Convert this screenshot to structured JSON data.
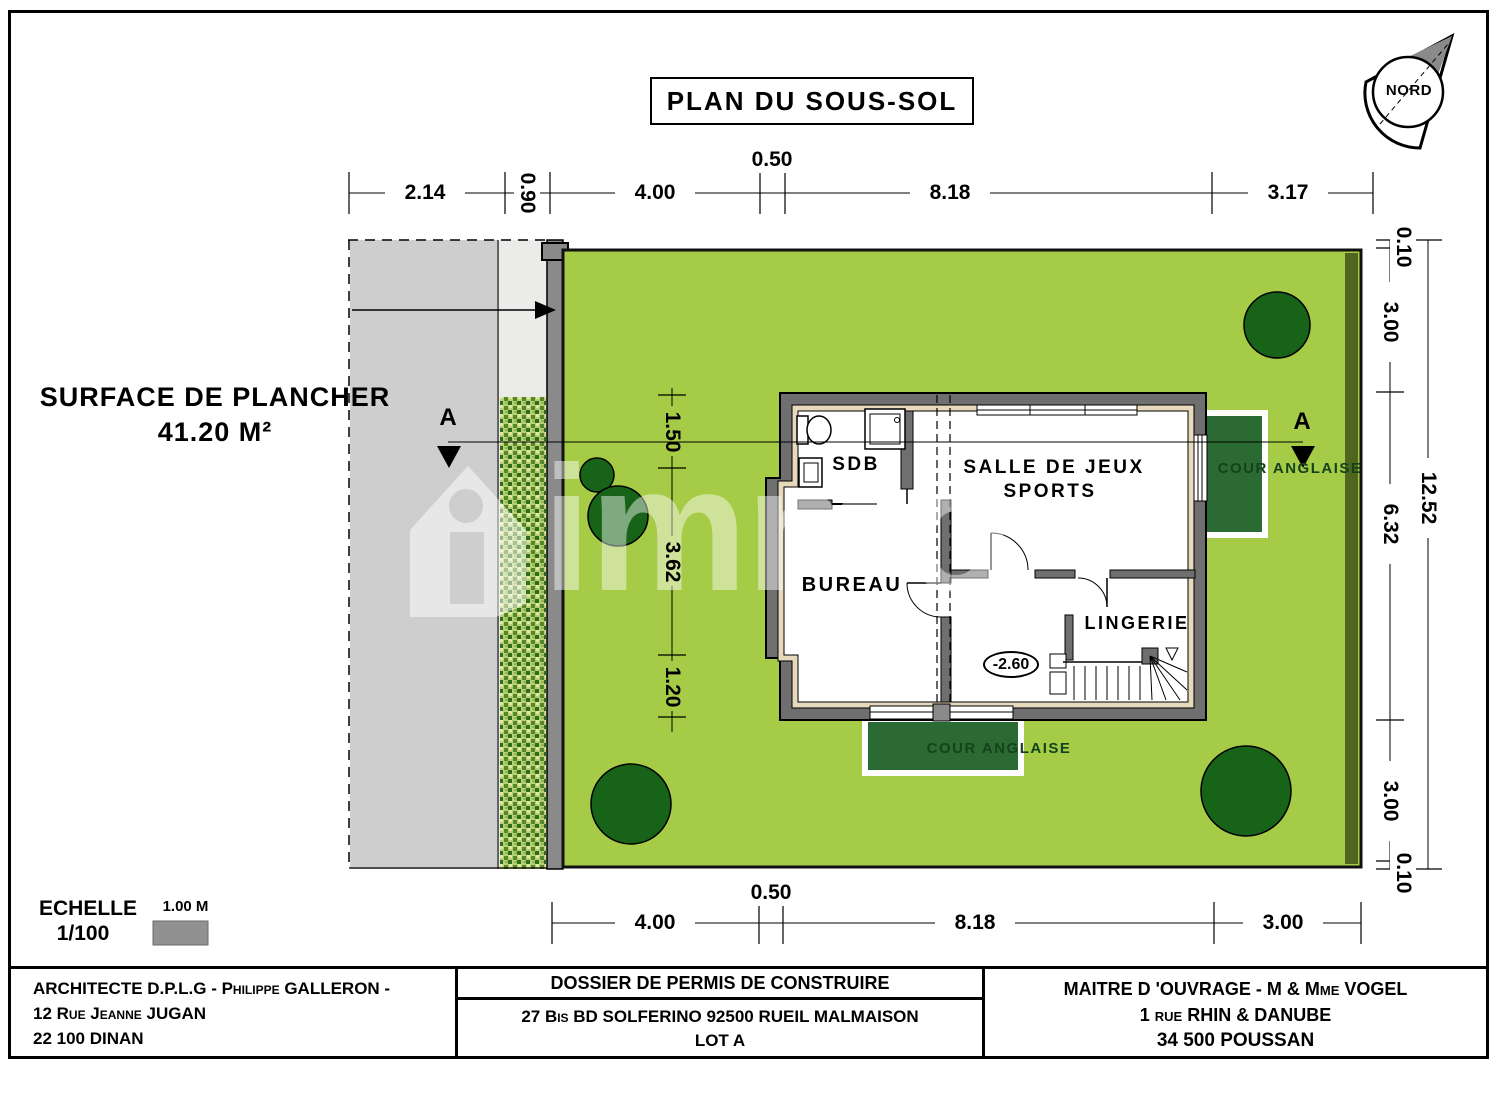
{
  "title": "PLAN DU SOUS-SOL",
  "compass": {
    "label": "NORD"
  },
  "surface": {
    "label": "SURFACE DE PLANCHER",
    "value": "41.20 M²"
  },
  "scale": {
    "label": "ECHELLE",
    "ratio": "1/100",
    "bar_label": "1.00 M"
  },
  "dims": {
    "top": [
      "2.14",
      "0.90",
      "4.00",
      "0.50",
      "8.18",
      "3.17"
    ],
    "right_inner": [
      "0.10",
      "3.00",
      "6.32",
      "3.00",
      "0.10"
    ],
    "right_outer": "12.52",
    "bottom": [
      "4.00",
      "0.50",
      "8.18",
      "3.00"
    ],
    "interior": [
      "1.50",
      "3.62",
      "1.20"
    ]
  },
  "section": {
    "marker_left": "A",
    "marker_right": "A"
  },
  "rooms": {
    "sdb": "SDB",
    "salle_line1": "SALLE DE JEUX",
    "salle_line2": "SPORTS",
    "bureau": "BUREAU",
    "lingerie": "LINGERIE",
    "level": "-2.60"
  },
  "site": {
    "cour_right": "COUR ANGLAISE",
    "cour_bottom": "COUR ANGLAISE"
  },
  "watermark": "immo",
  "titleblock": {
    "architect": [
      "ARCHITECTE D.P.L.G - Philippe GALLERON -",
      "12 Rue Jeanne JUGAN",
      "22 100 DINAN"
    ],
    "dossier_title": "DOSSIER DE PERMIS DE CONSTRUIRE",
    "dossier_address": "27 Bis BD SOLFERINO 92500 RUEIL MALMAISON",
    "dossier_lot": "LOT A",
    "owner": [
      "MAITRE D 'OUVRAGE - M & Mme VOGEL",
      "1 rue RHIN & DANUBE",
      "34 500 POUSSAN"
    ]
  },
  "colors": {
    "lawn": "#a6cb47",
    "tree": "#176419",
    "cour_anglaise": "#2b6b33",
    "boundary_wall": "#8a8a8a",
    "paved_area": "#cecece",
    "wall_fill": "#6f6f6f",
    "insulation_band": "#e6d9bc"
  }
}
